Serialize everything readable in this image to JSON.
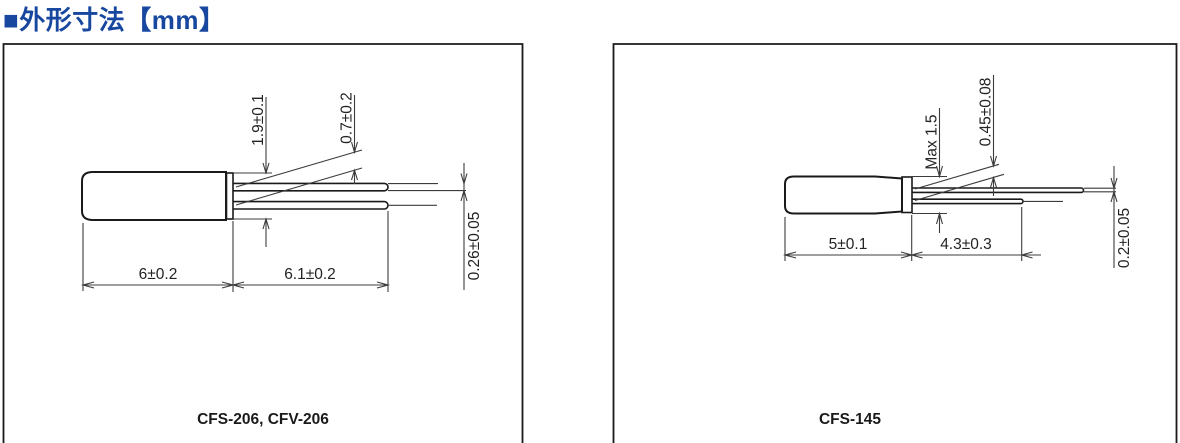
{
  "header": {
    "title": "■外形寸法【mm】",
    "title_color": "#17479E",
    "unit": "mm"
  },
  "colors": {
    "line": "#1a1a1a",
    "dimension_line": "#3c3c3c",
    "background": "#ffffff"
  },
  "panels": [
    {
      "caption": "CFS-206, CFV-206",
      "dims": {
        "seal_diameter": "1.9±0.1",
        "lead_pitch": "0.7±0.2",
        "lead_diameter": "0.26±0.05",
        "body_length": "6±0.2",
        "lead_length": "6.1±0.2"
      }
    },
    {
      "caption": "CFS-145",
      "dims": {
        "body_diameter_max": "Max 1.5",
        "lead_pitch": "0.45±0.08",
        "lead_diameter": "0.2±0.05",
        "body_length": "5±0.1",
        "lead_length": "4.3±0.3"
      }
    }
  ]
}
